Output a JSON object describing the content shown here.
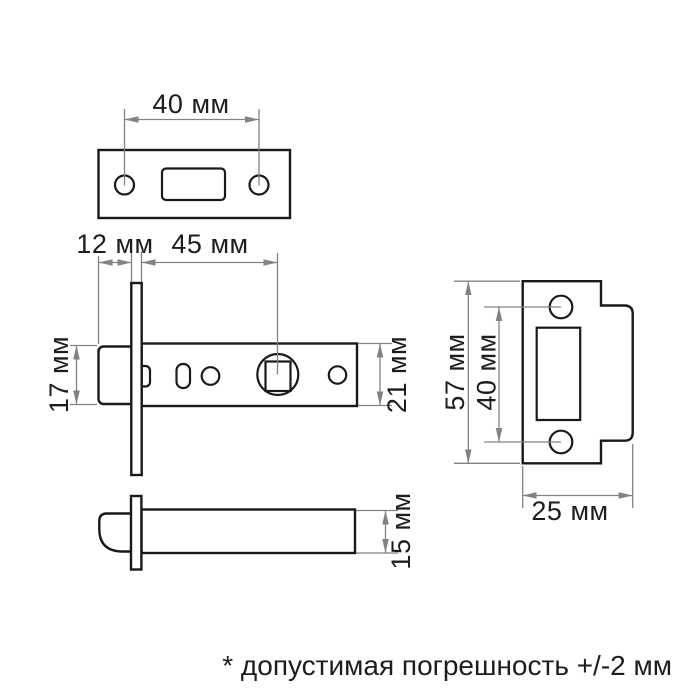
{
  "drawing": {
    "kind": "technical dimensional drawing of a door latch (mortise tubular latch) with strike plate",
    "units_note": "all labels in millimetres (мм)"
  },
  "views": {
    "faceplate_front": {
      "dims": {
        "hole_spacing": "40 мм"
      }
    },
    "latch_side": {
      "dims": {
        "bolt_offset": "12 мм",
        "backset": "45 мм",
        "bolt_height": "17 мм",
        "body_height": "21 мм"
      }
    },
    "strike_plate": {
      "dims": {
        "plate_height": "57 мм",
        "hole_spacing": "40 мм",
        "plate_width": "25 мм"
      }
    },
    "latch_bottom": {
      "dims": {
        "body_thickness": "15 мм"
      }
    }
  },
  "footnote": "* допустимая погрешность +/-2 мм",
  "colors": {
    "background": "#ffffff",
    "part_outline": "#191919",
    "dimension_lines": "#828282",
    "text": "#1d1d1b"
  }
}
